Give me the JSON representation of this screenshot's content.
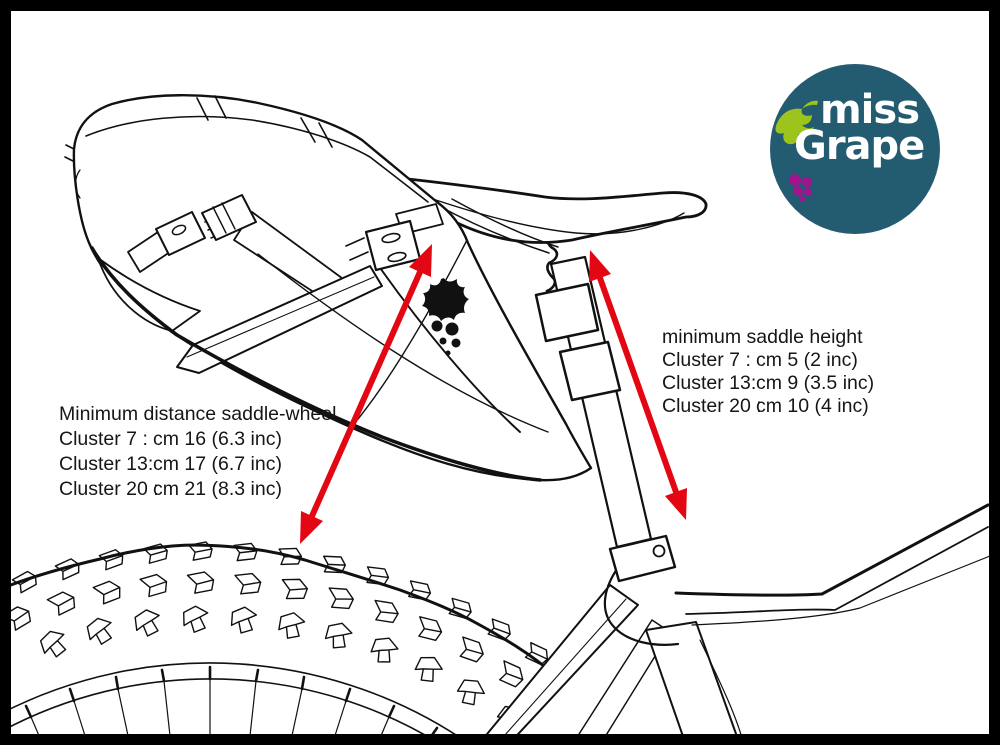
{
  "figure": {
    "type": "diagram",
    "subject": "Miss Grape saddle bag clearance diagram"
  },
  "annotations": {
    "saddle_wheel": {
      "title": "Minimum distance saddle-wheel",
      "rows": [
        {
          "label": "Cluster 7 :",
          "value": "cm 16 (6.3 inc)"
        },
        {
          "label": "Cluster 13:",
          "value": "cm 17 (6.7 inc)"
        },
        {
          "label": "Cluster 20 :",
          "value": "cm 21 (8.3 inc)"
        }
      ]
    },
    "saddle_height": {
      "title": "minimum saddle height",
      "rows": [
        {
          "label": "Cluster 7 :",
          "value": "cm 5 (2 inc)"
        },
        {
          "label": "Cluster 13:",
          "value": "cm 9 (3.5 inc)"
        },
        {
          "label": "Cluster 20 :",
          "value": "cm 10 (4 inc)"
        }
      ]
    }
  },
  "logo": {
    "line1": "miss",
    "line2": "Grape",
    "circle_color": "#235B71",
    "leaf_color": "#9DC41C",
    "grape_color": "#A0148E",
    "text_color": "#FFFFFF"
  },
  "colors": {
    "arrow_red": "#E30613",
    "line_black": "#111111",
    "background": "#FFFFFF",
    "border": "#000000"
  }
}
